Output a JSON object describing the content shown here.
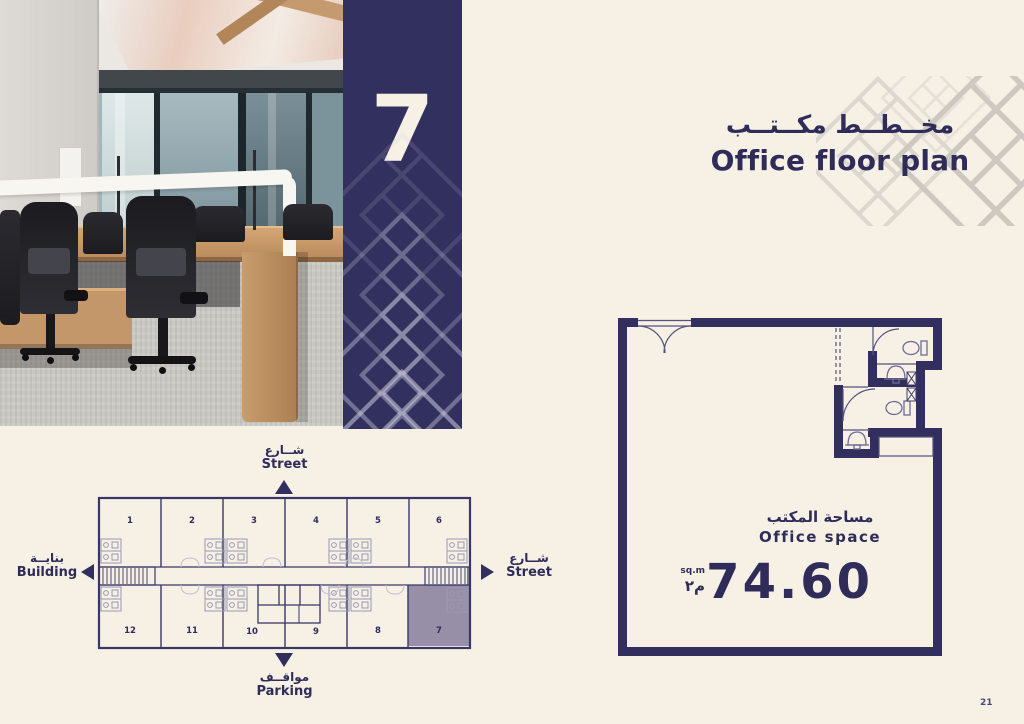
{
  "page": {
    "background_color": "#f6f0e5",
    "accent_color": "#322f5f",
    "page_number": "21"
  },
  "banner": {
    "unit_number": "7"
  },
  "title": {
    "arabic": "مخــطــط مكــتــب",
    "english": "Office floor plan"
  },
  "floor_plan": {
    "area_label_arabic": "مساحة المكتب",
    "area_label_english": "Office space",
    "area_value": "74.60",
    "area_unit_english": "sq.m",
    "area_unit_arabic": "م٢"
  },
  "site_plan": {
    "street_top": {
      "arabic": "شــارع",
      "english": "Street"
    },
    "street_right": {
      "arabic": "شــارع",
      "english": "Street"
    },
    "building_left": {
      "arabic": "بنايــة",
      "english": "Building"
    },
    "parking_bottom": {
      "arabic": "مواقــف",
      "english": "Parking"
    },
    "units_top": [
      "1",
      "2",
      "3",
      "4",
      "5",
      "6"
    ],
    "units_bottom": [
      "12",
      "11",
      "10",
      "9",
      "8",
      "7"
    ],
    "highlighted_unit": "7",
    "highlight_color": "#968fa7"
  }
}
